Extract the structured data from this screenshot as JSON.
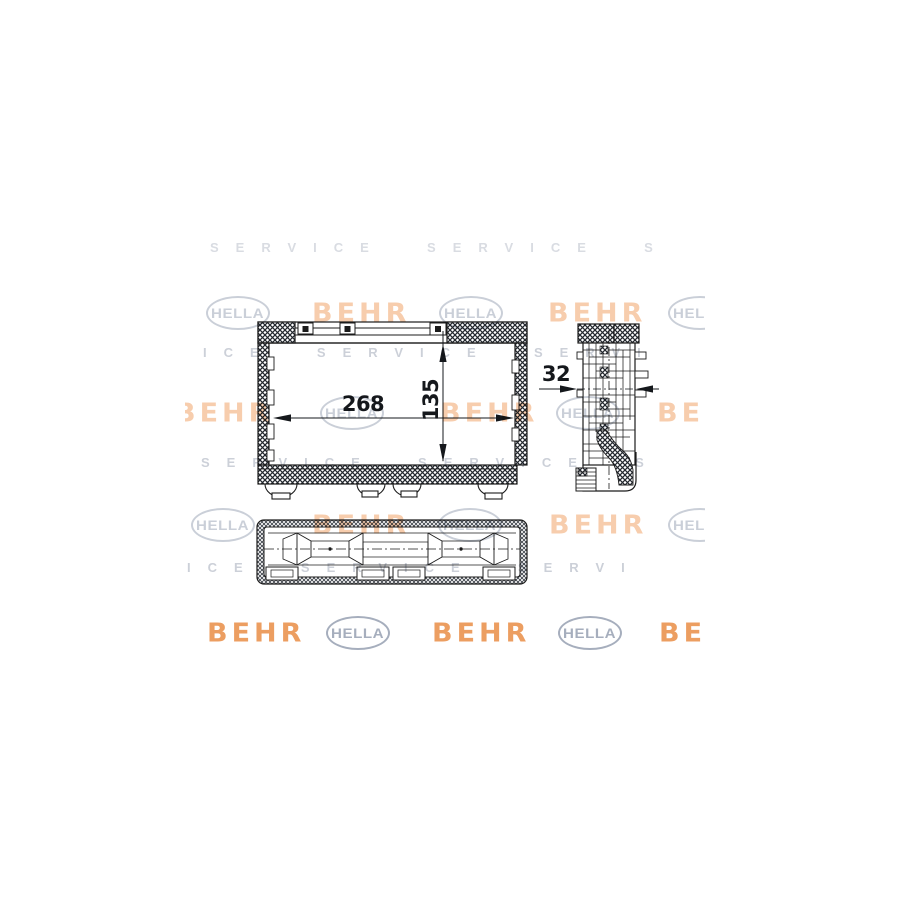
{
  "artwork": {
    "kind": "technical-drawing",
    "background": "#ffffff"
  },
  "watermark": {
    "hella_label": "HELLA",
    "behr_label": "BEHR",
    "service_line_a": "SERVICE  SERVICE  S",
    "service_line_b": "ICE  SERVICE  SERVI",
    "colors": {
      "hella_gray": "#9fa8b8",
      "behr_orange": "#f1a56b",
      "behr_orange_strong": "#eb9654",
      "service_gray": "#aab1bf"
    }
  },
  "drawing": {
    "dim_width": "268",
    "dim_height": "135",
    "dim_depth": "32",
    "line_color": "#1b1b1b"
  }
}
